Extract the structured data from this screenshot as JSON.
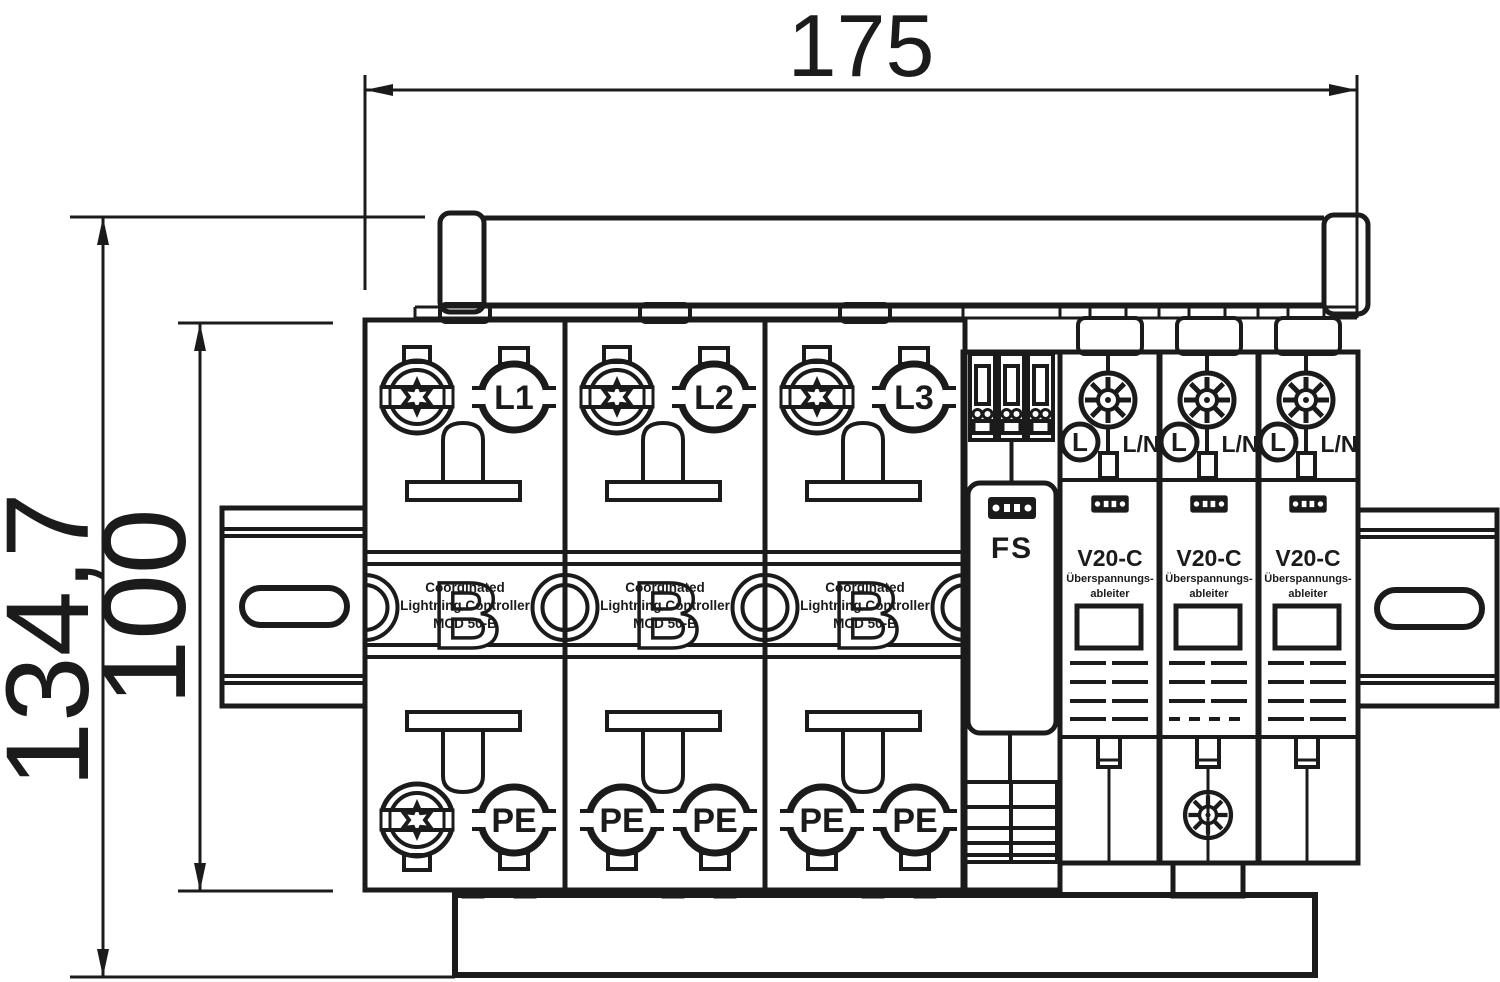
{
  "dimensions": {
    "width": "175",
    "height_total": "134,7",
    "height_inner": "100"
  },
  "mcd_modules": [
    {
      "top_label": "L1",
      "bottom_right_label": "PE"
    },
    {
      "top_label": "L2",
      "bottom_left_label": "PE",
      "bottom_right_label": "PE"
    },
    {
      "top_label": "L3",
      "bottom_left_label": "PE",
      "bottom_right_label": "PE"
    }
  ],
  "mcd_text": {
    "watermark": "B",
    "line1": "Coordinated",
    "line2": "Lightning Controller",
    "line3": "MCD 50-B"
  },
  "fs_module": {
    "label": "FS"
  },
  "v20c_modules": [
    {
      "terminal": "L",
      "wire": "L/N",
      "title": "V20-C",
      "subtitle1": "Überspannungs-",
      "subtitle2": "ableiter"
    },
    {
      "terminal": "L",
      "wire": "L/N",
      "title": "V20-C",
      "subtitle1": "Überspannungs-",
      "subtitle2": "ableiter"
    },
    {
      "terminal": "L",
      "wire": "L/N",
      "title": "V20-C",
      "subtitle1": "Überspannungs-",
      "subtitle2": "ableiter"
    }
  ],
  "colors": {
    "line": "#1b1b1b",
    "background": "#ffffff"
  }
}
